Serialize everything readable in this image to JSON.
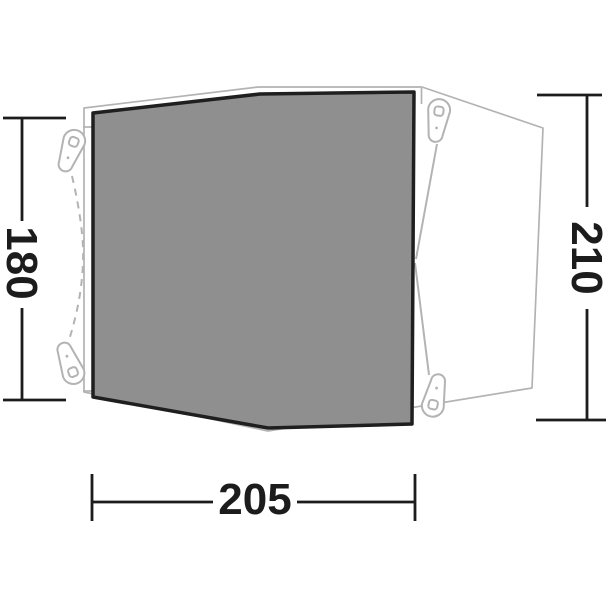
{
  "diagram": {
    "dimension_labels": {
      "left_height": "180",
      "right_height": "210",
      "bottom_width": "205"
    },
    "colors": {
      "background": "#ffffff",
      "floor_fill": "#8f8f8f",
      "floor_border": "#1f1f1f",
      "outline": "#b3b3b3",
      "dimension": "#1c1c1c"
    }
  }
}
